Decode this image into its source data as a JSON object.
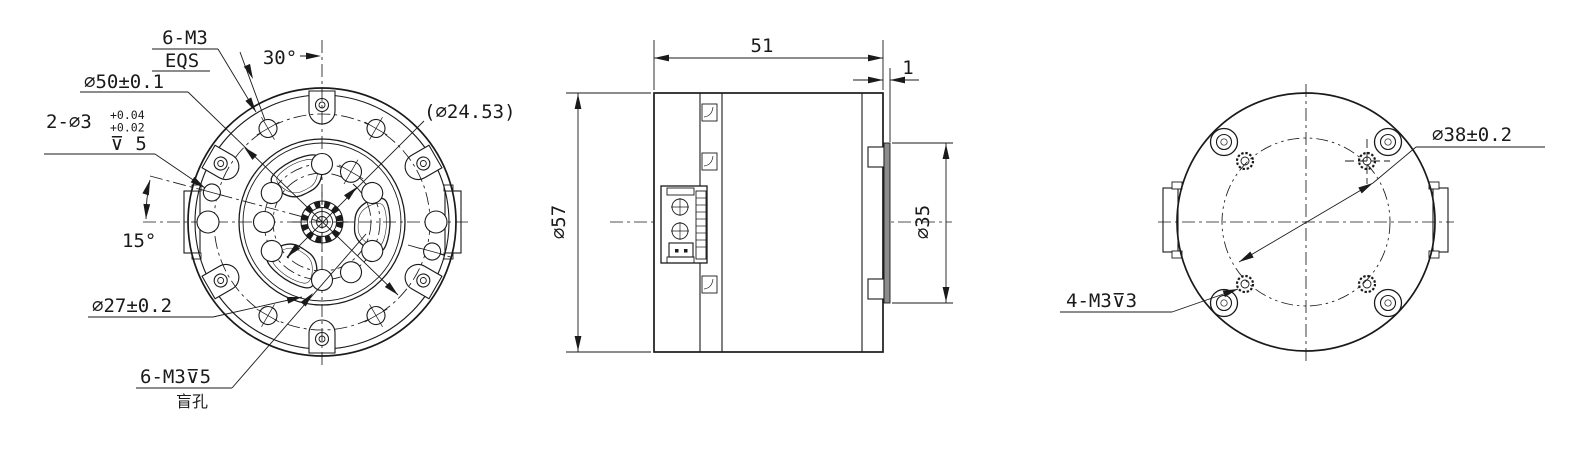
{
  "front": {
    "m3_count": "6-M3",
    "m3_eqs": "EQS",
    "angle30": "30°",
    "bcd50": "⌀50±0.1",
    "dowel": "2-⌀3",
    "dowel_tol_upper": "+0.04",
    "dowel_tol_lower": "+0.02",
    "dowel_depth": "⊽ 5",
    "angle15": "15°",
    "ref_dia": "(⌀24.53)",
    "bcd27": "⌀27±0.2",
    "blind_callout": "6-M3⊽5",
    "blind_note": "盲孔"
  },
  "side": {
    "length": "51",
    "flange": "1",
    "dia_outer": "⌀57",
    "dia_boss": "⌀35"
  },
  "back": {
    "bcd38": "⌀38±0.2",
    "tapped": "4-M3⊽3"
  },
  "colors": {
    "line": "#1a1a1a",
    "background": "#ffffff",
    "flange_fill": "#8c8c8c"
  }
}
